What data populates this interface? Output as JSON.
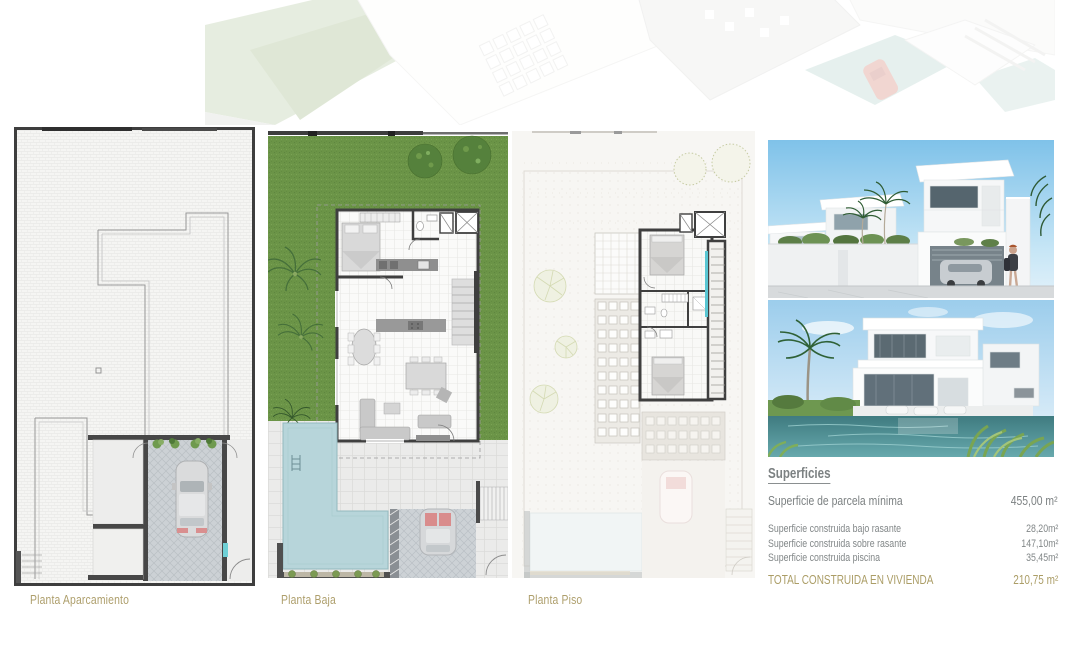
{
  "plans": [
    {
      "label": "Planta Aparcamiento"
    },
    {
      "label": "Planta Baja"
    },
    {
      "label": "Planta Piso"
    }
  ],
  "superficies": {
    "title": "Superficies",
    "parcela": {
      "label": "Superficie de parcela mínima",
      "value": "455,00 m²"
    },
    "rows": [
      {
        "label": "Superficie construida bajo rasante",
        "value": "28,20m²"
      },
      {
        "label": "Superficie construida sobre rasante",
        "value": "147,10m²"
      },
      {
        "label": "Superficie construida piscina",
        "value": "35,45m²"
      }
    ],
    "total": {
      "label": "TOTAL CONSTRUIDA EN VIVIENDA",
      "value": "210,75 m²"
    }
  },
  "colors": {
    "accent_gold": "#ab9d66",
    "text_gray": "#7c8182",
    "grass_green": "#6b9447",
    "pool_blue": "#b7d5da",
    "wall_dark": "#3f3f3f"
  }
}
